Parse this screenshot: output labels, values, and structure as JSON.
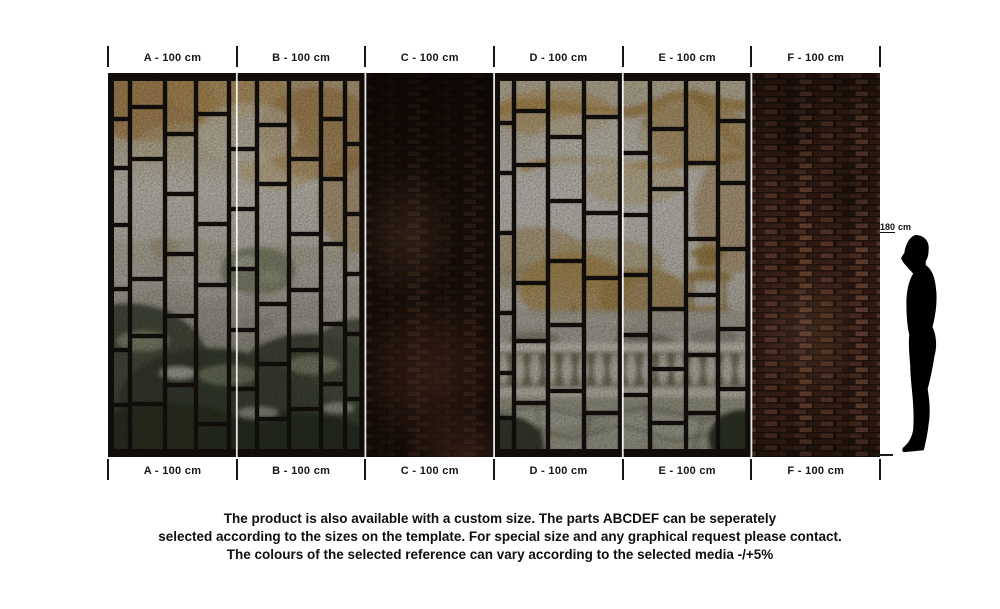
{
  "rulers": {
    "top": [
      "A - 100 cm",
      "B - 100 cm",
      "C - 100 cm",
      "D - 100 cm",
      "E - 100 cm",
      "F - 100 cm"
    ],
    "bottom": [
      "A - 100 cm",
      "B - 100 cm",
      "C - 100 cm",
      "D - 100 cm",
      "E - 100 cm",
      "F - 100 cm"
    ]
  },
  "panels": [
    {
      "id": "A",
      "surface": "stained-glass window over garden mural"
    },
    {
      "id": "B",
      "surface": "stained-glass window over garden mural"
    },
    {
      "id": "C",
      "surface": "dark brick wall"
    },
    {
      "id": "D",
      "surface": "stained-glass window over garden terrace mural"
    },
    {
      "id": "E",
      "surface": "stained-glass window over garden terrace mural"
    },
    {
      "id": "F",
      "surface": "red brick wall"
    }
  ],
  "figure": {
    "height_value": "180",
    "height_unit": "cm"
  },
  "footer": {
    "line1": "The product is also available with a custom size. The parts ABCDEF can be seperately",
    "line2": "selected according to the sizes on the template. For special size and any graphical request please contact.",
    "line3": "The colours of the selected reference can vary according to the selected media -/+5%"
  },
  "colors": {
    "tick": "#161616",
    "text": "#0f0f0f",
    "frame_black": "#17130f",
    "seam_white": "#ffffff",
    "brick_dark": "#2a1811",
    "brick_red": "#6b4434",
    "mural_gold": "#b9964f",
    "foliage_dark": "#3d4334"
  }
}
